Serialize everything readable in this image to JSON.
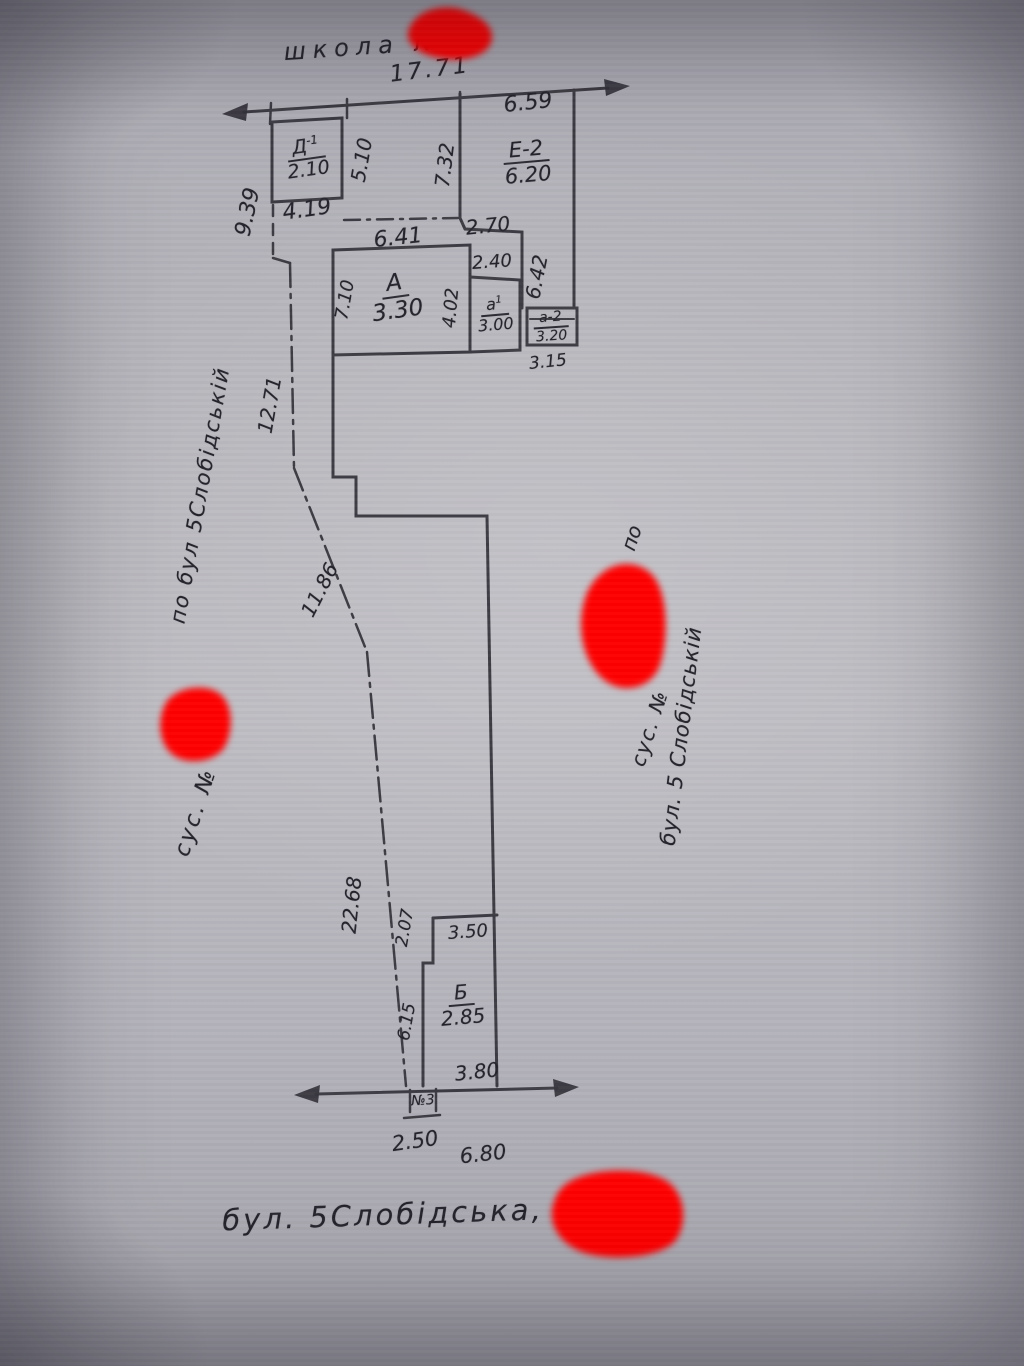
{
  "drawing": {
    "school_label": "школа №",
    "street_label": "бул. 5Слобідська,",
    "marker": "№3",
    "annotations": {
      "left_neighbor": "сус. №",
      "left_street": "по бул 5Слобідській",
      "right_neighbor": "сус. №",
      "right_po": "по",
      "right_street": "бул. 5 Слобідській"
    },
    "buildings": {
      "d1": {
        "name": "Д",
        "sup": "-1",
        "value": "2.10"
      },
      "e2": {
        "name": "Е-2",
        "value": "6.20"
      },
      "a": {
        "name": "А",
        "value": "3.30"
      },
      "a1": {
        "name": "а",
        "sup": "1",
        "value": "3.00"
      },
      "a2": {
        "name": "а-2",
        "value": "3.20"
      },
      "b": {
        "name": "Б",
        "value": "2.85"
      }
    },
    "dims": {
      "top_total": "17.71",
      "top_right": "6.59",
      "left_upper": "9.39",
      "d1_right": "5.10",
      "d1_bottom": "4.19",
      "mid_wall": "7.32",
      "a_top": "6.41",
      "mid_bottom": "2.70",
      "a1_top": "2.40",
      "right_inner": "6.42",
      "a_left": "7.10",
      "a_right": "4.02",
      "a2_bottom": "3.15",
      "west_upper": "12.71",
      "west_mid": "11.86",
      "west_lower": "22.68",
      "b_left_upper": "2.07",
      "b_top": "3.50",
      "b_left_lower": "6.15",
      "b_bottom": "3.80",
      "street_left": "2.50",
      "street_right": "6.80"
    }
  }
}
